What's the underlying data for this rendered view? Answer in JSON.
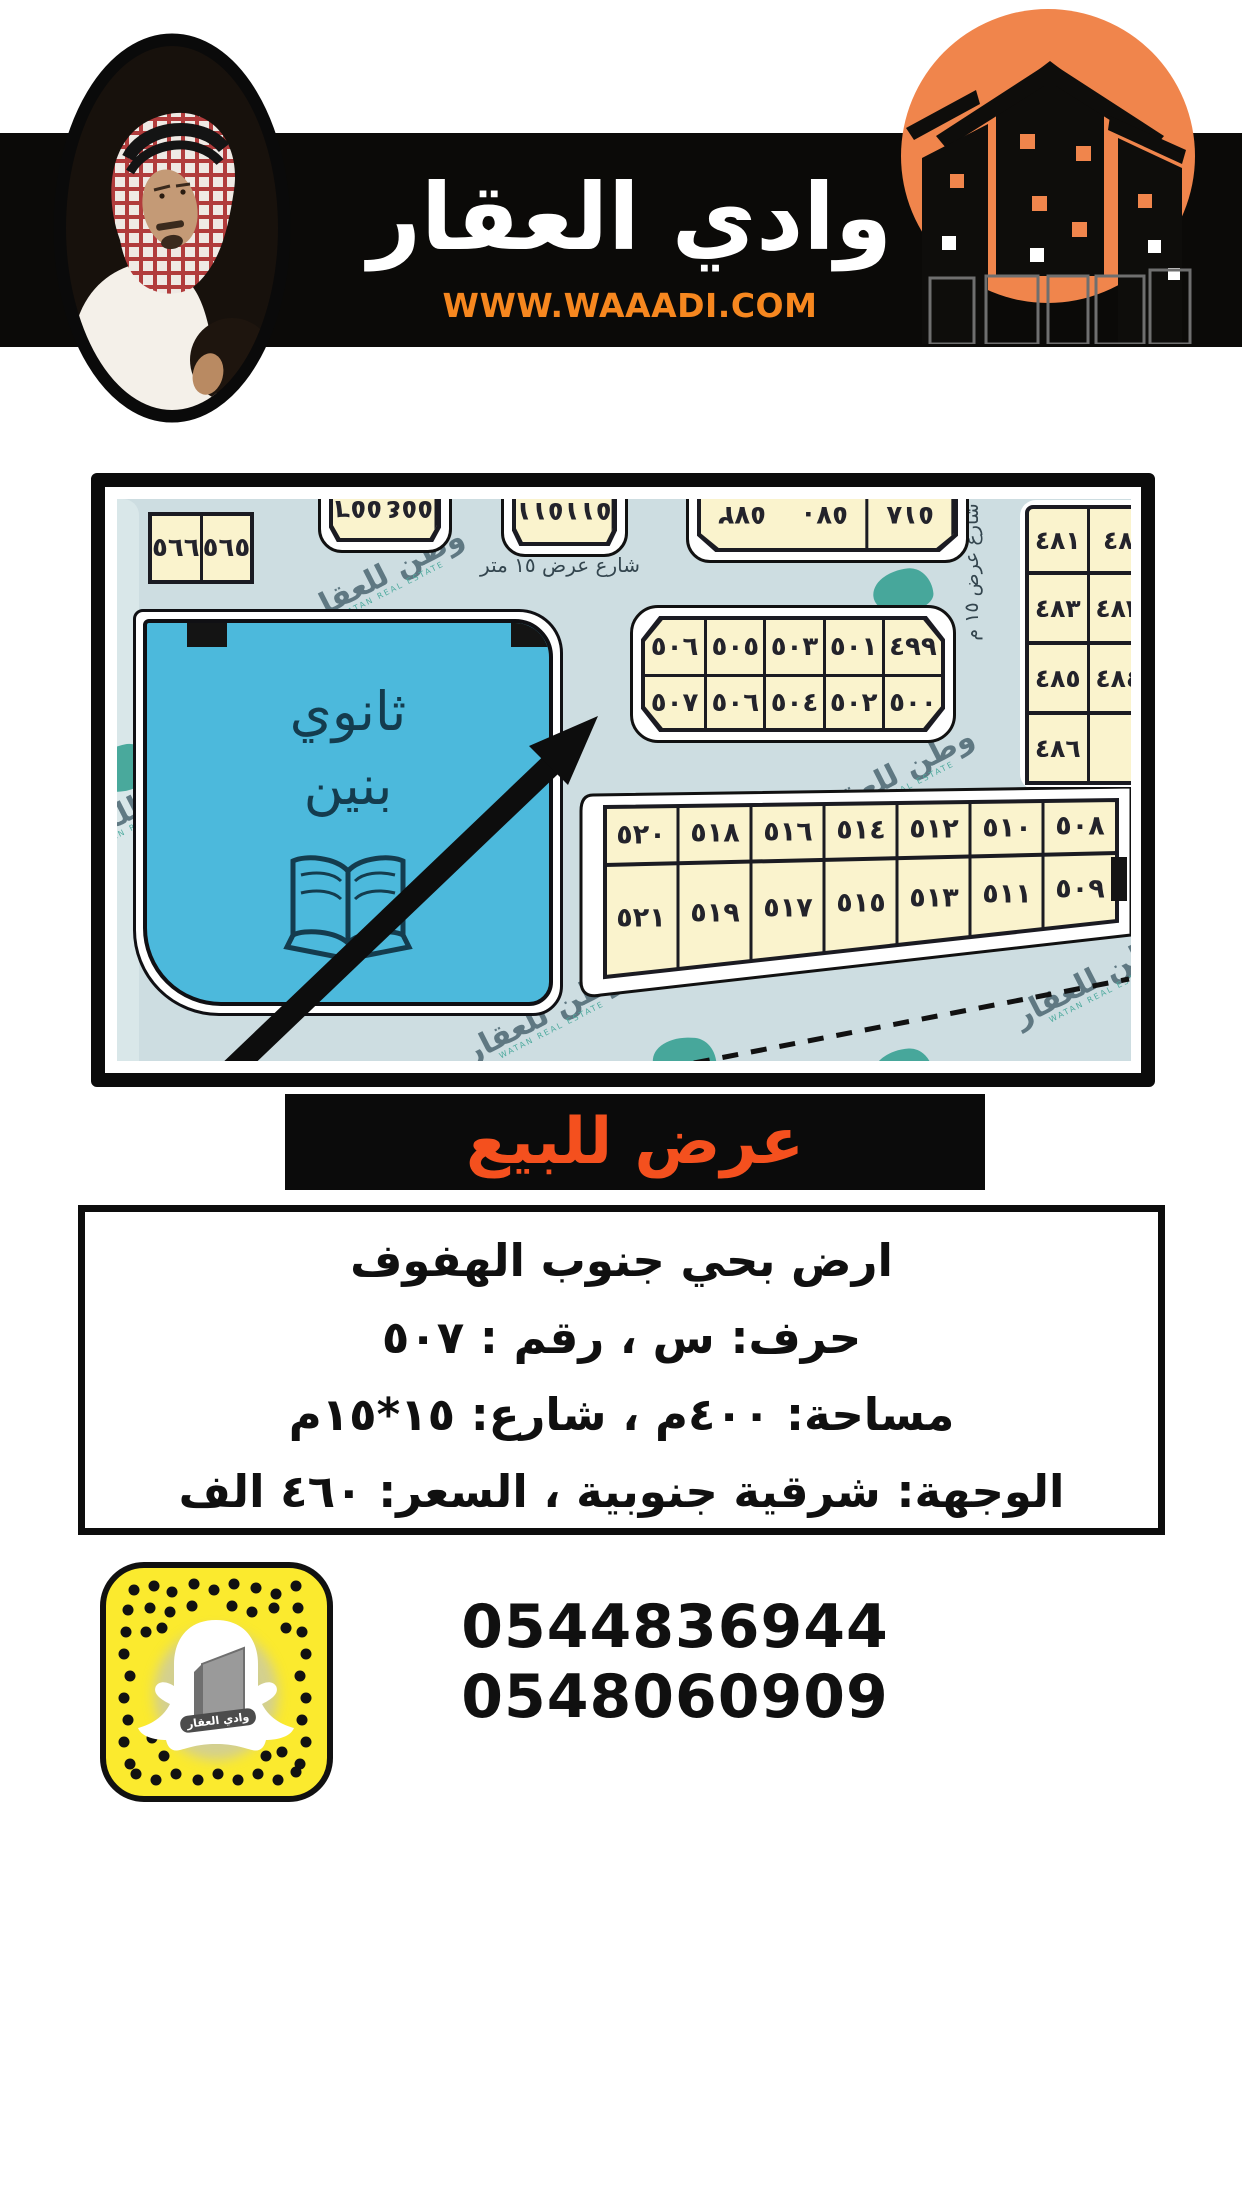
{
  "header": {
    "title": "وادي العقار",
    "website": "WWW.WAAADI.COM",
    "band_color": "#0b0a08",
    "brand_orange": "#F0854C",
    "url_orange": "#F6871F"
  },
  "map": {
    "school_line1": "ثانوي",
    "school_line2": "بنين",
    "street_top": "شارع عرض ١٥ متر",
    "street_mid": "شارع عرض ١٥ متر",
    "street_right_vertical": "شارع عرض ١٥ م",
    "street_left_vertical": "١٥ متر",
    "watermark_ar": "وطن للعقار",
    "watermark_en": "WATAN REAL ESTATE",
    "pair_block": [
      "٥٦٦",
      "٥٦٥"
    ],
    "top_block_a": [
      "٥٥٦",
      "٥٥٤"
    ],
    "top_block_b": [
      "٥١١",
      "٥١١"
    ],
    "top_block_c": [
      "٥٧٢",
      "٥٧٠",
      "٥١٨"
    ],
    "right_column": [
      [
        "٤٨١",
        "٤٨"
      ],
      [
        "٤٨٣",
        "٤٨٢"
      ],
      [
        "٤٨٥",
        "٤٨٤"
      ],
      [
        "٤٨٦",
        ""
      ]
    ],
    "center_block": {
      "row1": [
        "٥٠٦",
        "٥٠٥",
        "٥٠٣",
        "٥٠١",
        "٤٩٩"
      ],
      "row2": [
        "٥٠٧",
        "٥٠٦",
        "٥٠٤",
        "٥٠٢",
        "٥٠٠"
      ]
    },
    "bottom_block": {
      "row1": [
        "٥٢٠",
        "٥١٨",
        "٥١٦",
        "٥١٤",
        "٥١٢",
        "٥١٠",
        "٥٠٨"
      ],
      "row2": [
        "٥٢١",
        "٥١٩",
        "٥١٧",
        "٥١٥",
        "٥١٣",
        "٥١١",
        "٥٠٩"
      ]
    },
    "colors": {
      "street": "#cddde1",
      "plot": "#faf3cd",
      "school_blue": "#4cb9dc",
      "watermark_teal": "#2f9e8e"
    }
  },
  "offer": {
    "banner": "عرض للبيع",
    "accent": "#F4501E"
  },
  "details": {
    "line1": "ارض بحي جنوب الهفوف",
    "line2": "حرف: س ، رقم : ٥٠٧",
    "line3": "مساحة: ٤٠٠م ، شارع: ١٥*١٥م",
    "line4": "الوجهة: شرقية جنوبية ، السعر: ٤٦٠ الف"
  },
  "contact": {
    "phone1": "0544836944",
    "phone2": "0548060909",
    "snapcode_label": "وادي العقار",
    "snap_yellow": "#FBEA2E"
  }
}
